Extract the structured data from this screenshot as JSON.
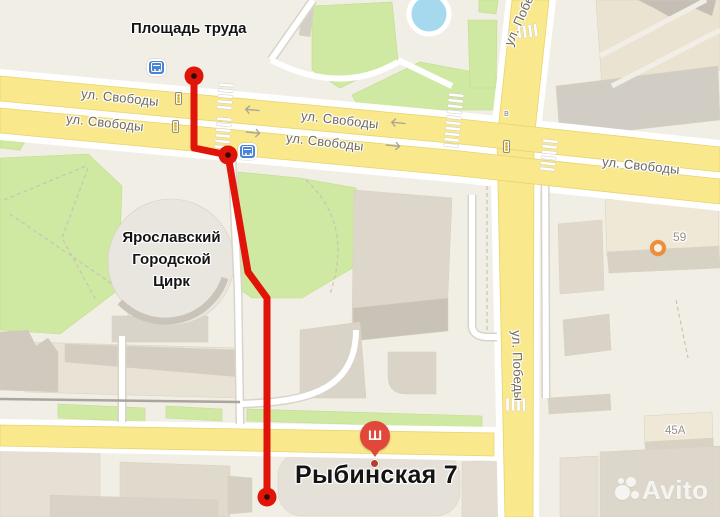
{
  "map": {
    "poi": {
      "square_label": "Площадь труда",
      "circus_line1": "Ярославский",
      "circus_line2": "Городской",
      "circus_line3": "Цирк",
      "destination_label": "Рыбинская 7",
      "building_59": "59",
      "building_45a": "45А",
      "entrance_letter": "в",
      "marker_glyph": "Ш"
    },
    "streets": {
      "svobody": "ул. Свободы",
      "pobedy": "ул. Победы"
    },
    "icons": {
      "bus_stop": "bus-stop-icon",
      "traffic_light": "traffic-light-icon",
      "destination_marker": "building-marker-icon",
      "organization_poi": "organization-poi-icon",
      "route_point": "route-endpoint-circle"
    },
    "colors": {
      "background": "#f1eee6",
      "road_yellow": "#f9e88c",
      "road_white": "#ffffff",
      "park_green": "#cfe8a2",
      "building_beige": "#ece4d2",
      "building_gray": "#d2cdc4",
      "route_red": "#e01408",
      "marker_red": "#e2483a",
      "poi_orange": "#ef8e3a",
      "water_blue": "#a6d8ee"
    },
    "watermark": {
      "brand": "Avito"
    }
  }
}
